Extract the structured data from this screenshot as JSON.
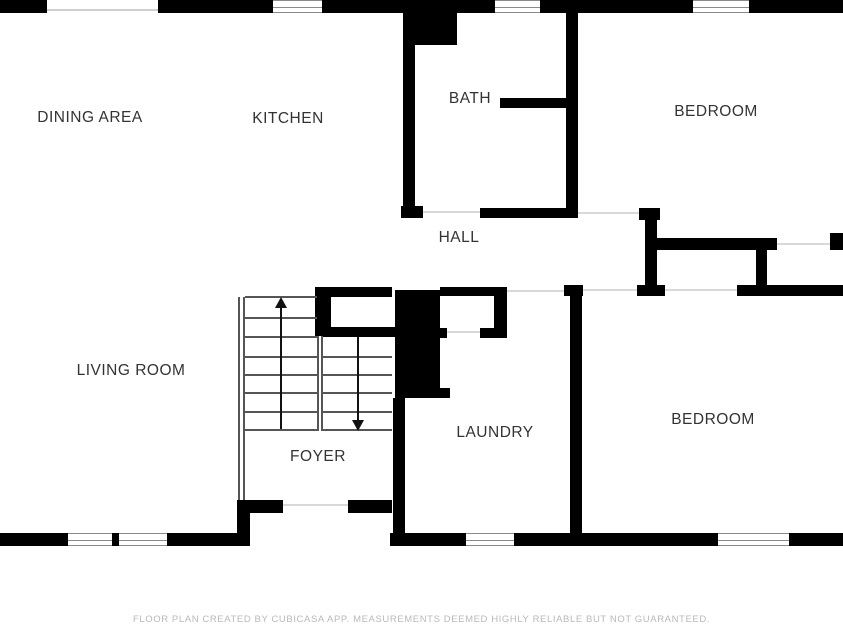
{
  "plan": {
    "title": "Floor plan",
    "rooms": [
      {
        "id": "dining-area",
        "label": "DINING AREA"
      },
      {
        "id": "kitchen",
        "label": "KITCHEN"
      },
      {
        "id": "bath",
        "label": "BATH"
      },
      {
        "id": "bedroom-top",
        "label": "BEDROOM"
      },
      {
        "id": "hall",
        "label": "HALL"
      },
      {
        "id": "living-room",
        "label": "LIVING ROOM"
      },
      {
        "id": "foyer",
        "label": "FOYER"
      },
      {
        "id": "laundry",
        "label": "LAUNDRY"
      },
      {
        "id": "bedroom-bottom",
        "label": "BEDROOM"
      }
    ],
    "stairs": {
      "up_arrow": "up",
      "down_arrow": "down"
    },
    "colors": {
      "wall": "#000000",
      "background": "#ffffff",
      "label_text": "#333333",
      "window_frame": "#8a8a8a",
      "opening_line": "#d9d9d9",
      "stair_line": "#555555",
      "footer_text": "#b9b9b9"
    }
  },
  "footer": {
    "disclaimer": "FLOOR PLAN CREATED BY CUBICASA APP. MEASUREMENTS DEEMED HIGHLY RELIABLE BUT NOT GUARANTEED."
  }
}
